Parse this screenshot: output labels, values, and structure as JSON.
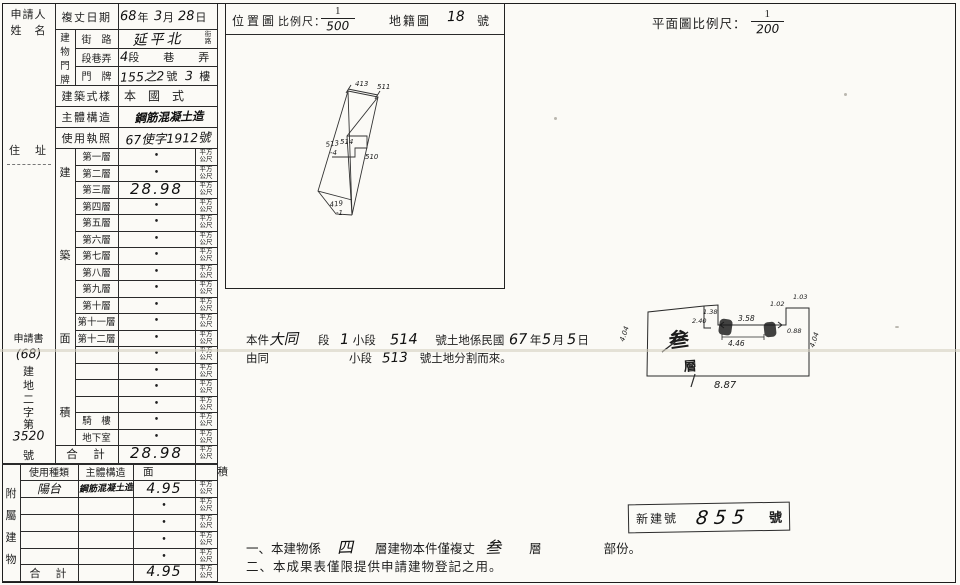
{
  "left_table": {
    "applicant_l1": "申請人",
    "applicant_l2": "姓　名",
    "address_label": "住　址",
    "docno": [
      {
        "t": "p",
        "v": "申請書"
      },
      {
        "t": "h",
        "v": "(68)"
      },
      {
        "t": "p",
        "v": "建"
      },
      {
        "t": "p",
        "v": "地"
      },
      {
        "t": "p",
        "v": "二"
      },
      {
        "t": "p",
        "v": "字"
      },
      {
        "t": "p",
        "v": "第"
      },
      {
        "t": "h",
        "v": "3520"
      },
      {
        "t": "p",
        "v": "號"
      }
    ],
    "survey_date_label": "複丈日期",
    "date_value": [
      {
        "t": "h",
        "v": "68"
      },
      {
        "t": "p",
        "v": "年"
      },
      {
        "t": "h",
        "v": "3"
      },
      {
        "t": "p",
        "v": "月"
      },
      {
        "t": "h",
        "v": "28"
      },
      {
        "t": "p",
        "v": "日"
      }
    ],
    "door_label_chars": [
      "建",
      "物",
      "門",
      "牌"
    ],
    "street_label": "街　路",
    "street_value": "延平北",
    "street_unit_l1": "街",
    "street_unit_l2": "路",
    "sec_label": "段巷弄",
    "sec_value": [
      {
        "t": "h",
        "v": "4"
      },
      {
        "t": "p",
        "v": "段"
      },
      {
        "t": "p",
        "v": "巷"
      },
      {
        "t": "p",
        "v": "弄"
      }
    ],
    "door_label": "門　牌",
    "door_value": [
      {
        "t": "h",
        "v": "155之2"
      },
      {
        "t": "p",
        "v": "號"
      },
      {
        "t": "h",
        "v": "3"
      },
      {
        "t": "p",
        "v": "樓"
      }
    ],
    "style_label": "建築式樣",
    "style_value": "本　國　式",
    "structure_label": "主體構造",
    "structure_value": "鋼筋混凝土造",
    "license_label": "使用執照",
    "license_value": "67使字1912號",
    "floor_side_chars": [
      "建",
      "築",
      "面",
      "積"
    ],
    "floors": [
      {
        "label": "第一層",
        "value": "•"
      },
      {
        "label": "第二層",
        "value": "•"
      },
      {
        "label": "第三層",
        "value": "28.98"
      },
      {
        "label": "第四層",
        "value": "•"
      },
      {
        "label": "第五層",
        "value": "•"
      },
      {
        "label": "第六層",
        "value": "•"
      },
      {
        "label": "第七層",
        "value": "•"
      },
      {
        "label": "第八層",
        "value": "•"
      },
      {
        "label": "第九層",
        "value": "•"
      },
      {
        "label": "第十層",
        "value": "•"
      },
      {
        "label": "第十一層",
        "value": "•"
      },
      {
        "label": "第十二層",
        "value": "•"
      },
      {
        "label": "",
        "value": "•"
      },
      {
        "label": "",
        "value": "•"
      },
      {
        "label": "",
        "value": "•"
      },
      {
        "label": "",
        "value": "•"
      },
      {
        "label": "騎　樓",
        "value": "•"
      },
      {
        "label": "地下室",
        "value": "•"
      }
    ],
    "total_label": "合　計",
    "total_value": "28.98",
    "unit_l1": "平方",
    "unit_l2": "公尺"
  },
  "annex": {
    "side_chars": [
      "附",
      "屬",
      "建",
      "物"
    ],
    "header_use": "使用種類",
    "header_structure": "主體構造",
    "header_area_l": "面",
    "header_area_r": "積",
    "rows": [
      {
        "use": "陽台",
        "structure": "鋼筋混凝土造",
        "value": "4.95"
      },
      {
        "use": "",
        "structure": "",
        "value": "•"
      },
      {
        "use": "",
        "structure": "",
        "value": "•"
      },
      {
        "use": "",
        "structure": "",
        "value": "•"
      },
      {
        "use": "",
        "structure": "",
        "value": "•"
      }
    ],
    "total_label": "合　計",
    "total_value": "4.95"
  },
  "location_map": {
    "title": "位置圖",
    "scale_label": "比例尺：",
    "scale_num": "1",
    "scale_den": "500",
    "cadastral_label": "地籍圖",
    "sheet_no": "18",
    "sheet_suffix": "號",
    "labels": [
      {
        "v": "413"
      },
      {
        "v": "511"
      },
      {
        "v": "513"
      },
      {
        "v": "-4"
      },
      {
        "v": "514"
      },
      {
        "v": "510"
      },
      {
        "v": "419"
      },
      {
        "v": "-1"
      }
    ]
  },
  "plan": {
    "title": "平面圖比例尺：",
    "scale_num": "1",
    "scale_den": "200",
    "stamp_floor": "叁",
    "stamp_level": "層",
    "dims": [
      {
        "v": "2.40"
      },
      {
        "v": "1.38"
      },
      {
        "v": "3.58"
      },
      {
        "v": "1.02"
      },
      {
        "v": "1.03"
      },
      {
        "v": "0.88"
      },
      {
        "v": "4.46"
      },
      {
        "v": "8.87"
      },
      {
        "v": "4.04"
      },
      {
        "v": "4.04"
      }
    ]
  },
  "parcel_note": {
    "line1": [
      {
        "t": "p",
        "v": "本件"
      },
      {
        "t": "h",
        "v": "大同"
      },
      {
        "t": "p",
        "v": "段"
      },
      {
        "t": "h",
        "v": "1"
      },
      {
        "t": "p",
        "v": "小段"
      },
      {
        "t": "h",
        "v": "514"
      },
      {
        "t": "p",
        "v": "號土地係民國"
      },
      {
        "t": "h",
        "v": "67"
      },
      {
        "t": "p",
        "v": "年"
      },
      {
        "t": "h",
        "v": "5"
      },
      {
        "t": "p",
        "v": "月"
      },
      {
        "t": "h",
        "v": "5"
      },
      {
        "t": "p",
        "v": "日"
      }
    ],
    "line2": [
      {
        "t": "p",
        "v": "由同"
      },
      {
        "t": "p",
        "v": "小段"
      },
      {
        "t": "h",
        "v": "513"
      },
      {
        "t": "p",
        "v": "號土地分割而來。"
      }
    ]
  },
  "stamp_box": {
    "label": "新建號",
    "value": "855",
    "suffix": "號"
  },
  "notes": {
    "line1": [
      {
        "t": "p",
        "v": "一、本建物係"
      },
      {
        "t": "h",
        "v": "四"
      },
      {
        "t": "p",
        "v": "層建物本件僅複丈"
      },
      {
        "t": "h",
        "v": "叁"
      },
      {
        "t": "p",
        "v": "層"
      },
      {
        "t": "p",
        "v": "部份。"
      }
    ],
    "line2": "二、本成果表僅限提供申請建物登記之用。"
  }
}
